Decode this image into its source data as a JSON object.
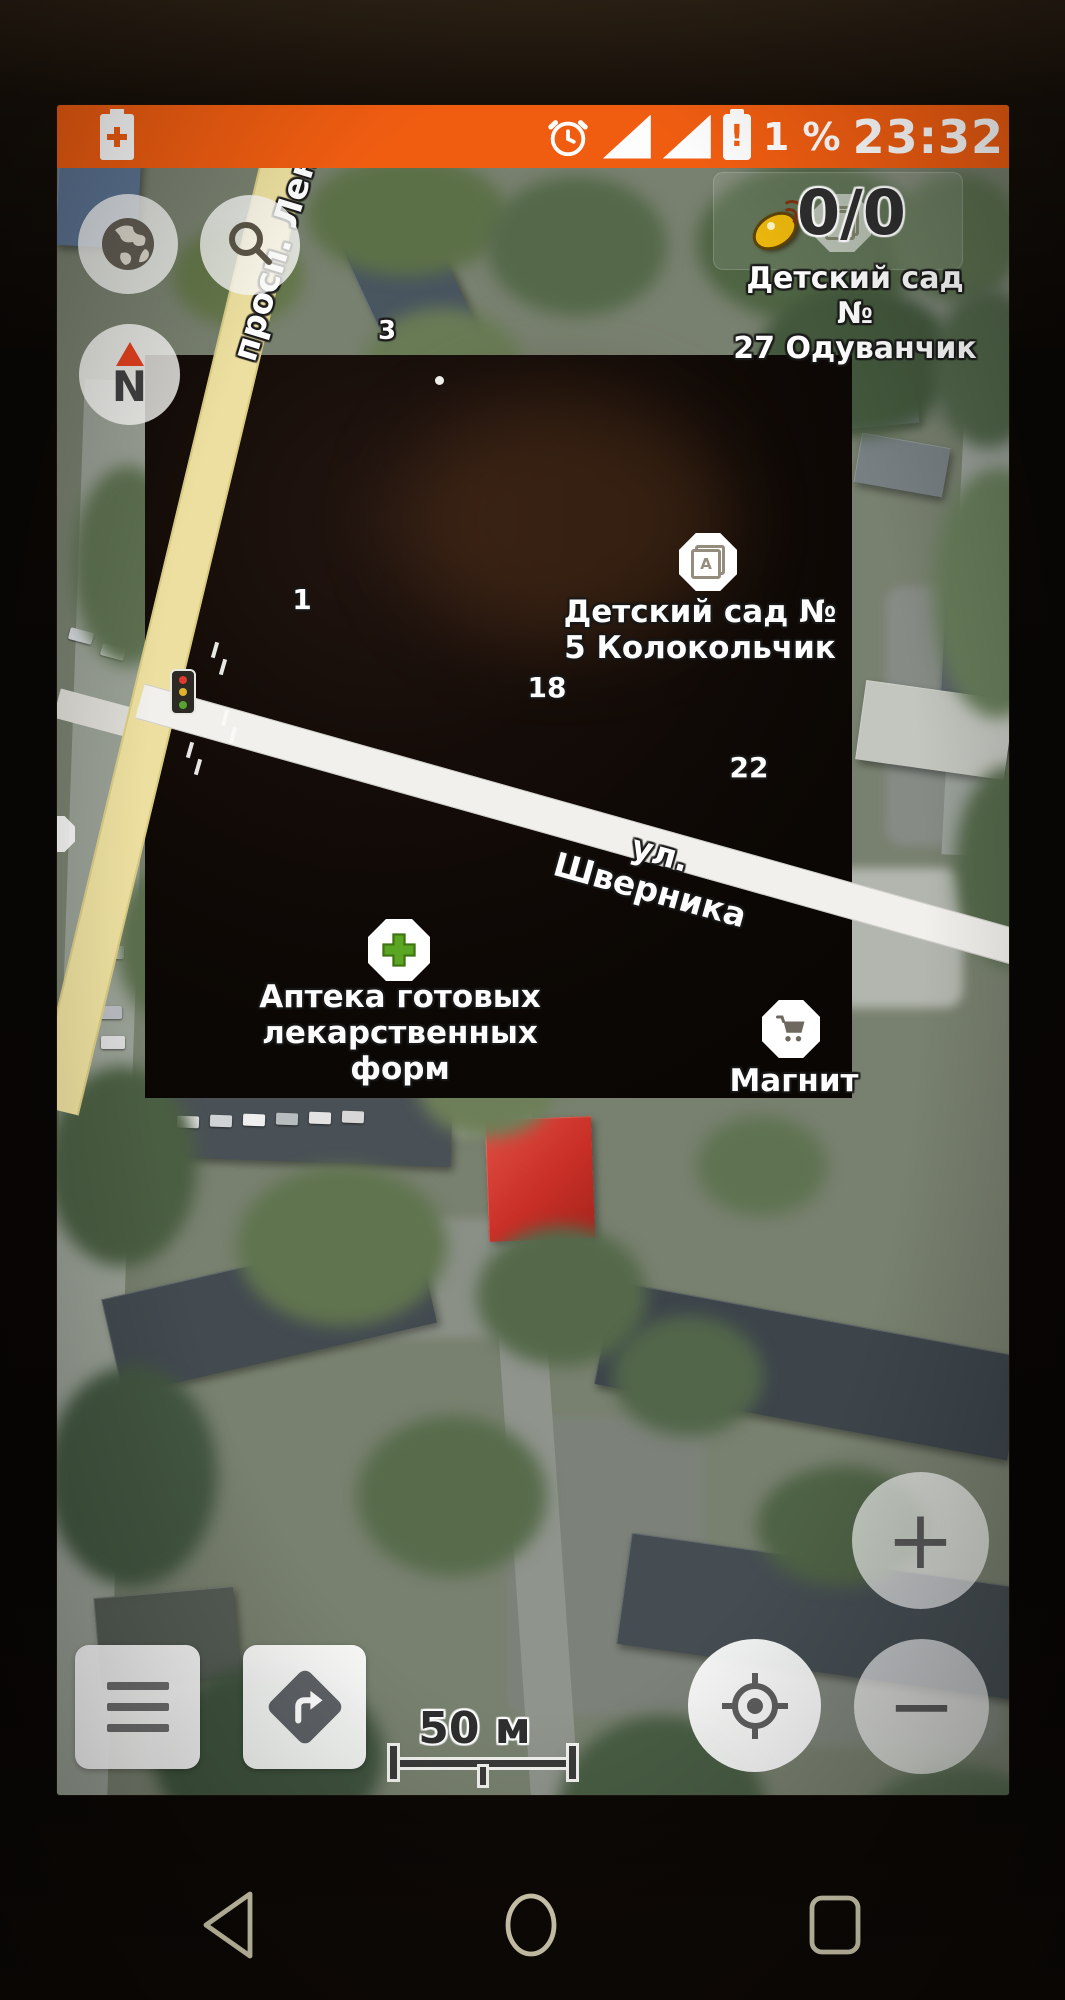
{
  "status_bar": {
    "time": "23:32",
    "battery_level": "1 %",
    "alert_mark": "!"
  },
  "gps": {
    "counter": "0/0"
  },
  "compass": {
    "label": "N"
  },
  "streets": {
    "lenina": "просп. Лен",
    "shvernika": "ул. Шверника"
  },
  "houses": {
    "h3": "3",
    "h1": "1",
    "h18": "18",
    "h22": "22"
  },
  "poi": {
    "k27": {
      "line1": "Детский сад №",
      "line2": "27 Одуванчик"
    },
    "k5": {
      "line1": "Детский сад №",
      "line2": "5 Колокольчик",
      "icon_letter": "А"
    },
    "pharmacy": {
      "line1": "Аптека готовых",
      "line2": "лекарственных форм"
    },
    "magnit": {
      "name": "Магнит"
    }
  },
  "scale": {
    "label": "50 м"
  },
  "controls": {
    "zoom_in": "+",
    "zoom_out": "−"
  },
  "colors": {
    "status_bar": "#f05d11",
    "pharmacy_cross": "#5aa622",
    "compass_needle": "#e2401f",
    "satellite_dish": "#eab60d",
    "red_building": "#cc3128",
    "yellow_road": "#ecdf9f"
  }
}
